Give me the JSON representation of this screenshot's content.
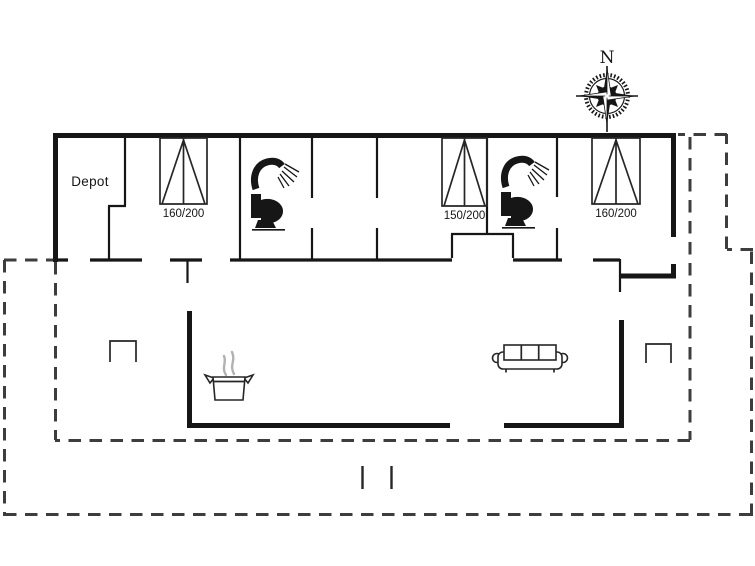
{
  "labels": {
    "depot": "Depot",
    "compass_north": "N"
  },
  "beds": [
    {
      "size_label": "160/200"
    },
    {
      "size_label": "150/200"
    },
    {
      "size_label": "160/200"
    }
  ],
  "icons": {
    "compass": "compass-rose-icon",
    "shower": "shower-icon",
    "toilet": "toilet-icon",
    "cooking_pot": "cooking-pot-icon",
    "sofa": "sofa-icon",
    "double_bed": "double-bed-icon",
    "table": "table-icon"
  },
  "colors": {
    "line": "#161616",
    "dashed_line": "#3d3d3d",
    "steam": "#b1b1b1",
    "background": "#ffffff"
  }
}
